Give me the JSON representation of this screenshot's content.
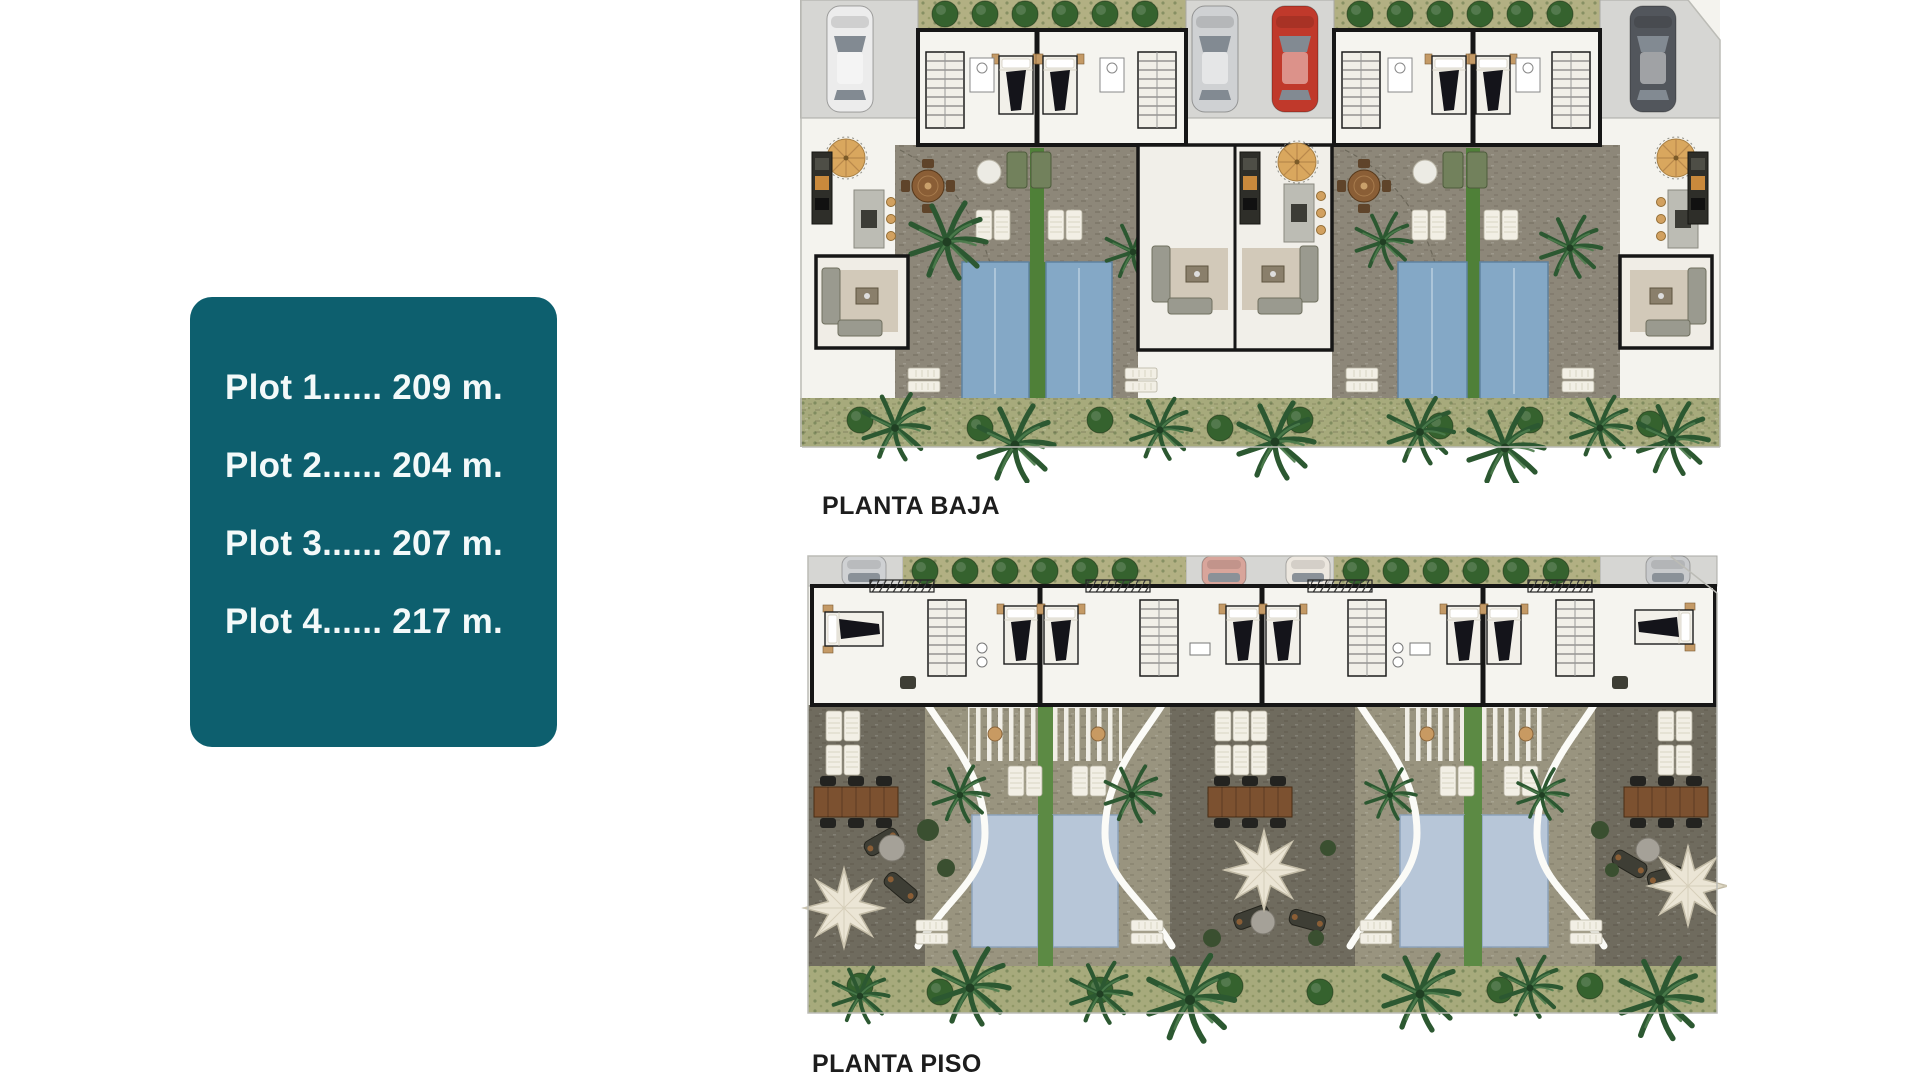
{
  "plot_panel": {
    "items": [
      "Plot 1...... 209 m.",
      "Plot 2...... 204 m.",
      "Plot 3...... 207 m.",
      "Plot 4...... 217 m."
    ]
  },
  "plans": {
    "baja": {
      "label": "PLANTA BAJA"
    },
    "piso": {
      "label": "PLANTA PISO"
    }
  },
  "colors": {
    "teal-panel": "#0d5f6e",
    "panel-text": "#f3f9f9",
    "label-text": "#1d1d1d",
    "driveway": "#d6d6d3",
    "floor": "#f4f3ee",
    "hedge": "#b2b083",
    "terrace-baja": "#8d8779",
    "terrace-piso-light": "#99947f",
    "terrace-piso-dark": "#6f6b5e",
    "pool-baja": "#84a8c6",
    "pool-piso": "#b7c6d8",
    "grass": "#4f8038",
    "landscape": "#a7aa7c",
    "wall": "#161616",
    "car-white": "#ececec",
    "car-silver": "#cfd1d3",
    "car-red": "#c0392b",
    "car-dark": "#52565c"
  }
}
